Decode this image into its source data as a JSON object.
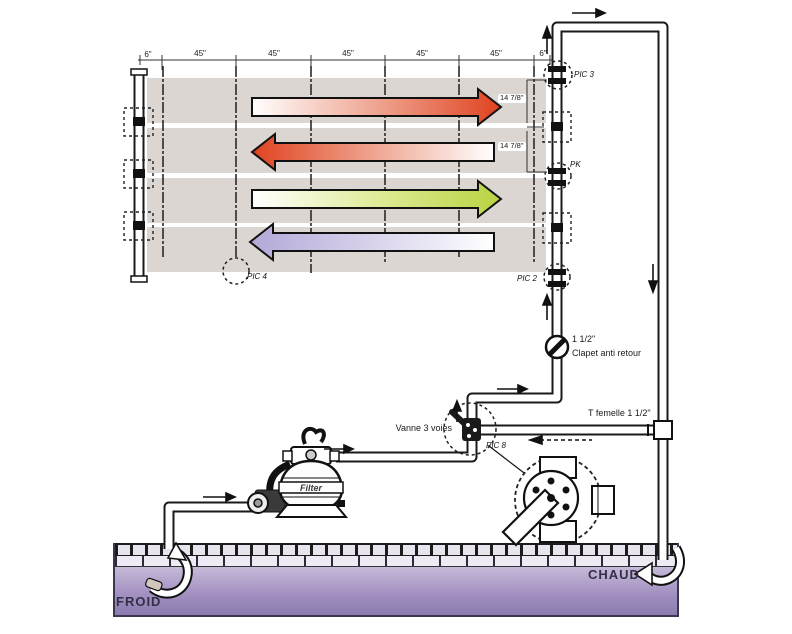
{
  "diagram": {
    "type": "solar-pool-heating-schematic",
    "dimensions": {
      "left_end": "6\"",
      "spans_45": [
        "45\"",
        "45\"",
        "45\"",
        "45\"",
        "45\""
      ],
      "right_end": "6\"",
      "panel_row_height_1": "14 7/8\"",
      "panel_row_height_2": "14 7/8\""
    },
    "sensors": {
      "pic3": "PIC 3",
      "pk": "PK",
      "pic2": "PIC 2",
      "pic4": "PIC 4",
      "pic8": "PIC 8"
    },
    "labels": {
      "check_valve_size": "1 1/2\"",
      "check_valve": "Clapet anti retour",
      "tee_fitting": "T femelle 1 1/2\"",
      "three_way_valve": "Vanne 3 voies",
      "filter": "Filter",
      "cold_water": "FROID",
      "hot_water": "CHAUD"
    },
    "colors": {
      "arrow_hot_red": "#e0421f",
      "arrow_green": "#b7d342",
      "arrow_cool_purple": "#b4a8d8",
      "panel_grey": "#dbd6d1",
      "pool_water_top": "#c6bad8",
      "pool_water_bottom": "#8b7ab0"
    }
  }
}
